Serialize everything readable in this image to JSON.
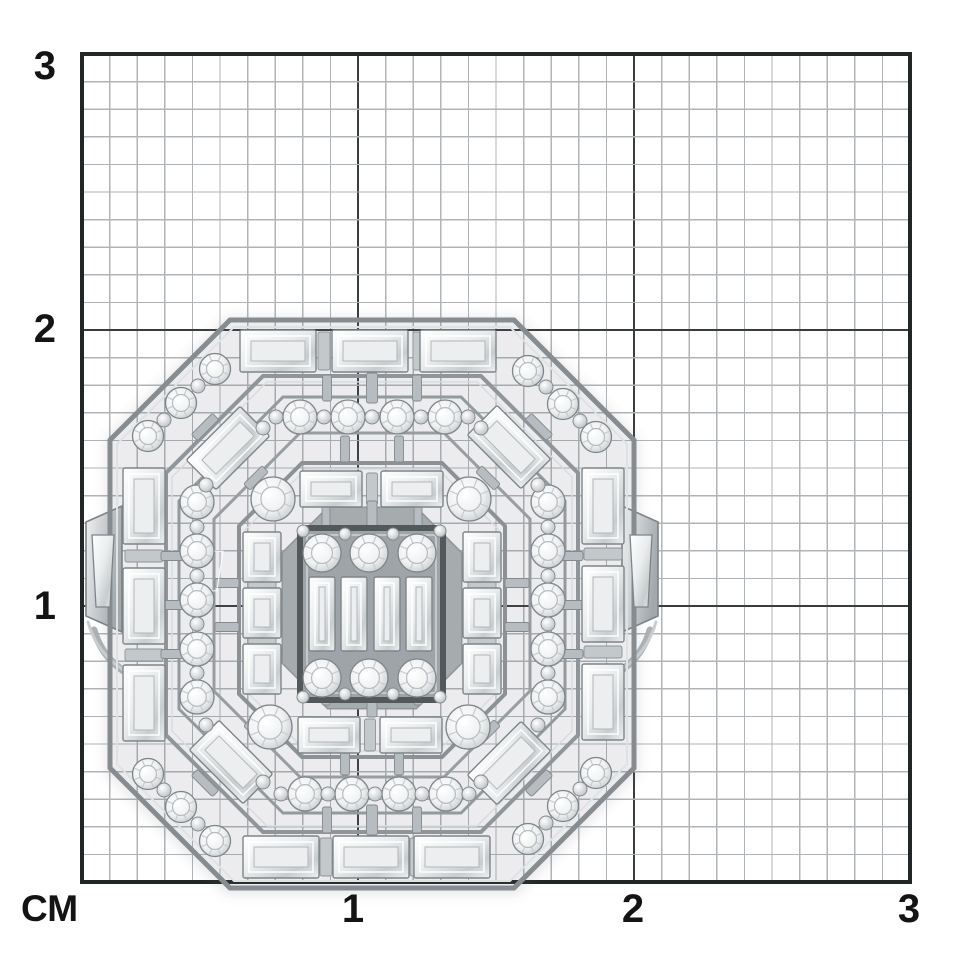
{
  "meta": {
    "description": "White-gold openwork cocktail ring with baguette and round diamonds photographed face-up on a centimeter measurement grid"
  },
  "grid": {
    "x0": 82,
    "y0": 54,
    "x1": 910,
    "y1": 882,
    "cm_px": 276,
    "minor_per_cm": 10,
    "minor_color": "#b0b4b6",
    "major_color": "#3a3d3e",
    "border_color": "#232626",
    "left_labels": [
      {
        "text": "3"
      },
      {
        "text": "2"
      },
      {
        "text": "1"
      }
    ],
    "bottom_labels": [
      {
        "text": "1"
      },
      {
        "text": "2"
      },
      {
        "text": "3"
      }
    ],
    "unit": {
      "text": "СМ"
    }
  },
  "ring": {
    "palette": {
      "rail_dark": "#868c90",
      "rail_mid": "#9aa1a5",
      "rail_light": "#dfe2e3",
      "strut_fill": "#b6bcbf",
      "strut_edge": "#83898d",
      "bar_fill": "#c3c8cb",
      "bar_edge": "#8d9397",
      "plate_edge": "#7c8286",
      "inner_fill": "#a6abae",
      "cluster_fill": "#9ea4a7",
      "cluster_frame": "#53585b",
      "cluster_hi": "#d0d4d6",
      "stone_edge": "#7e8488",
      "stone_mid_line": "#ffffff",
      "stone_core": "#eceeef",
      "stone_core_edge": "#b2b7ba",
      "round_inner": "#b6bbbe",
      "round_spoke": "#c6cbce",
      "bead_edge": "#858b8f",
      "shadow": "rgba(95,101,105,0.12)"
    },
    "shadow_oct": [
      372,
      606,
      268,
      290,
      122
    ],
    "rails": [
      [
        372,
        604,
        262,
        284,
        120,
        5,
        "#868c90"
      ],
      [
        372,
        604,
        255,
        277,
        117,
        2,
        "#dfe2e3"
      ],
      [
        372,
        604,
        206,
        228,
        97,
        4,
        "#8f9599"
      ],
      [
        372,
        604,
        200,
        222,
        95,
        1.5,
        "#d8dbdd"
      ],
      [
        372,
        605,
        193,
        208,
        104,
        3,
        "#939a9d"
      ],
      [
        372,
        605,
        158,
        172,
        86,
        3,
        "#979da0"
      ],
      [
        372,
        610,
        133,
        147,
        63,
        4,
        "#8b9195"
      ],
      [
        372,
        610,
        127,
        141,
        61,
        1.5,
        "#d8dbdd"
      ],
      [
        372,
        608,
        89,
        100,
        45,
        3,
        "#8f9599"
      ]
    ],
    "inner_fill_oct": [
      372,
      608,
      89,
      100,
      45
    ],
    "shank": {
      "plates": [
        [
          [
            86,
            522
          ],
          [
            122,
            506
          ],
          [
            122,
            632
          ],
          [
            86,
            616
          ]
        ],
        [
          [
            622,
            506
          ],
          [
            658,
            522
          ],
          [
            658,
            616
          ],
          [
            622,
            632
          ]
        ]
      ],
      "arcs": [
        {
          "d": "M 94 630 C 102 658 122 674 150 684",
          "w": 7,
          "c": "#aab0b3"
        },
        {
          "d": "M 88 622 C 96 650 114 668 140 678",
          "w": 3,
          "c": "#c9cdcf"
        },
        {
          "d": "M 650 630 C 642 658 622 674 594 684",
          "w": 7,
          "c": "#aab0b3"
        },
        {
          "d": "M 656 622 C 648 650 630 668 604 678",
          "w": 3,
          "c": "#c9cdcf"
        }
      ],
      "taper_stones": [
        [
          [
            92,
            535
          ],
          [
            114,
            535
          ],
          [
            110,
            607
          ],
          [
            96,
            607
          ]
        ],
        [
          [
            630,
            535
          ],
          [
            652,
            535
          ],
          [
            648,
            607
          ],
          [
            634,
            607
          ]
        ]
      ]
    },
    "channel_bars": [
      [
        324,
        351,
        38,
        90,
        12
      ],
      [
        419,
        351,
        38,
        90,
        12
      ],
      [
        326,
        857,
        38,
        90,
        12
      ],
      [
        416,
        857,
        38,
        90,
        12
      ],
      [
        144,
        556,
        38,
        0,
        12
      ],
      [
        144,
        655,
        38,
        0,
        12
      ],
      [
        603,
        554,
        38,
        0,
        12
      ],
      [
        603,
        652,
        38,
        0,
        12
      ],
      [
        372,
        489,
        32,
        90,
        11
      ],
      [
        370,
        735,
        32,
        90,
        11
      ],
      [
        262,
        585,
        28,
        0,
        10
      ],
      [
        262,
        641,
        28,
        0,
        10
      ],
      [
        482,
        585,
        28,
        0,
        10
      ],
      [
        482,
        641,
        28,
        0,
        10
      ]
    ],
    "struts": [
      [
        327,
        388,
        26,
        90,
        9
      ],
      [
        372,
        388,
        30,
        90,
        11
      ],
      [
        417,
        388,
        26,
        90,
        9
      ],
      [
        327,
        820,
        26,
        90,
        9
      ],
      [
        372,
        820,
        30,
        90,
        11
      ],
      [
        417,
        820,
        26,
        90,
        9
      ],
      [
        172,
        556,
        22,
        0,
        9
      ],
      [
        172,
        605,
        22,
        0,
        9
      ],
      [
        172,
        654,
        22,
        0,
        9
      ],
      [
        572,
        556,
        22,
        0,
        9
      ],
      [
        572,
        605,
        22,
        0,
        9
      ],
      [
        572,
        654,
        22,
        0,
        9
      ],
      [
        345,
        449,
        26,
        90,
        9
      ],
      [
        399,
        449,
        26,
        90,
        9
      ],
      [
        345,
        762,
        26,
        90,
        9
      ],
      [
        399,
        762,
        26,
        90,
        9
      ],
      [
        227,
        583,
        24,
        0,
        9
      ],
      [
        227,
        627,
        24,
        0,
        9
      ],
      [
        517,
        583,
        24,
        0,
        9
      ],
      [
        517,
        627,
        24,
        0,
        9
      ],
      [
        372,
        514,
        26,
        90,
        10
      ],
      [
        326,
        516,
        22,
        90,
        8
      ],
      [
        418,
        516,
        22,
        90,
        8
      ],
      [
        372,
        704,
        26,
        90,
        10
      ],
      [
        326,
        694,
        22,
        90,
        8
      ],
      [
        418,
        694,
        22,
        90,
        8
      ],
      [
        205,
        427,
        30,
        -45,
        9
      ],
      [
        256,
        478,
        26,
        -45,
        9
      ],
      [
        539,
        427,
        30,
        45,
        9
      ],
      [
        488,
        478,
        26,
        45,
        9
      ],
      [
        205,
        783,
        30,
        45,
        9
      ],
      [
        256,
        732,
        26,
        45,
        9
      ],
      [
        539,
        783,
        30,
        -45,
        9
      ],
      [
        488,
        732,
        26,
        -45,
        9
      ]
    ],
    "cluster_frame": {
      "x": 300,
      "y": 528,
      "w": 143,
      "h": 172
    },
    "baguettes": [
      [
        278,
        351,
        76,
        42,
        0
      ],
      [
        370,
        351,
        76,
        42,
        0
      ],
      [
        458,
        351,
        76,
        42,
        0
      ],
      [
        281,
        857,
        76,
        42,
        0
      ],
      [
        371,
        857,
        76,
        42,
        0
      ],
      [
        452,
        857,
        76,
        42,
        0
      ],
      [
        144,
        506,
        42,
        76,
        0
      ],
      [
        144,
        606,
        42,
        76,
        0
      ],
      [
        144,
        703,
        42,
        76,
        0
      ],
      [
        603,
        506,
        42,
        76,
        0
      ],
      [
        603,
        604,
        42,
        76,
        0
      ],
      [
        603,
        702,
        42,
        76,
        0
      ],
      [
        228,
        448,
        76,
        42,
        -45
      ],
      [
        509,
        447,
        76,
        42,
        45
      ],
      [
        231,
        762,
        76,
        42,
        45
      ],
      [
        509,
        763,
        76,
        42,
        -45
      ],
      [
        331,
        489,
        62,
        36,
        0
      ],
      [
        412,
        489,
        62,
        36,
        0
      ],
      [
        329,
        735,
        62,
        36,
        0
      ],
      [
        411,
        735,
        62,
        36,
        0
      ],
      [
        262,
        557,
        38,
        50,
        0
      ],
      [
        262,
        613,
        38,
        50,
        0
      ],
      [
        262,
        669,
        38,
        50,
        0
      ],
      [
        482,
        557,
        38,
        50,
        0
      ],
      [
        482,
        613,
        38,
        50,
        0
      ],
      [
        482,
        669,
        38,
        50,
        0
      ],
      [
        322,
        614,
        26,
        74,
        0
      ],
      [
        354,
        614,
        26,
        74,
        0
      ],
      [
        387,
        614,
        26,
        74,
        0
      ],
      [
        419,
        614,
        26,
        74,
        0
      ]
    ],
    "rounds": [
      [
        215,
        369,
        15.5
      ],
      [
        181,
        403,
        15.5
      ],
      [
        148,
        436,
        15.5
      ],
      [
        528,
        371,
        15.5
      ],
      [
        563,
        404,
        15.5
      ],
      [
        596,
        437,
        15.5
      ],
      [
        148,
        774,
        15.5
      ],
      [
        181,
        807,
        15.5
      ],
      [
        215,
        841,
        15.5
      ],
      [
        596,
        773,
        15.5
      ],
      [
        563,
        806,
        15.5
      ],
      [
        528,
        839,
        15.5
      ],
      [
        300,
        417,
        17
      ],
      [
        348,
        417,
        17
      ],
      [
        397,
        417,
        17
      ],
      [
        445,
        417,
        17
      ],
      [
        305,
        794,
        17
      ],
      [
        352,
        794,
        17
      ],
      [
        399,
        794,
        17
      ],
      [
        446,
        794,
        17
      ],
      [
        197,
        502,
        17
      ],
      [
        197,
        551,
        17
      ],
      [
        197,
        600,
        17
      ],
      [
        197,
        649,
        17
      ],
      [
        197,
        697,
        17
      ],
      [
        548,
        502,
        17
      ],
      [
        548,
        551,
        17
      ],
      [
        548,
        600,
        17
      ],
      [
        548,
        649,
        17
      ],
      [
        548,
        697,
        17
      ],
      [
        273,
        499,
        22
      ],
      [
        469,
        499,
        22
      ],
      [
        270,
        727,
        22
      ],
      [
        468,
        727,
        22
      ],
      [
        322,
        553,
        19
      ],
      [
        369,
        553,
        19
      ],
      [
        417,
        553,
        19
      ],
      [
        322,
        678,
        19
      ],
      [
        369,
        678,
        19
      ],
      [
        417,
        678,
        19
      ]
    ],
    "beads": [
      [
        198,
        386,
        7
      ],
      [
        164,
        420,
        7
      ],
      [
        546,
        387,
        7
      ],
      [
        580,
        421,
        7
      ],
      [
        164,
        790,
        7
      ],
      [
        198,
        824,
        7
      ],
      [
        580,
        789,
        7
      ],
      [
        546,
        823,
        7
      ],
      [
        276,
        417,
        7
      ],
      [
        324,
        417,
        7
      ],
      [
        372,
        417,
        7
      ],
      [
        421,
        417,
        7
      ],
      [
        468,
        417,
        7
      ],
      [
        281,
        794,
        7
      ],
      [
        328,
        794,
        7
      ],
      [
        375,
        794,
        7
      ],
      [
        422,
        794,
        7
      ],
      [
        469,
        794,
        7
      ],
      [
        197,
        527,
        7
      ],
      [
        197,
        576,
        7
      ],
      [
        197,
        624,
        7
      ],
      [
        197,
        673,
        7
      ],
      [
        548,
        527,
        7
      ],
      [
        548,
        576,
        7
      ],
      [
        548,
        624,
        7
      ],
      [
        548,
        673,
        7
      ],
      [
        263,
        428,
        7
      ],
      [
        481,
        428,
        7
      ],
      [
        206,
        485,
        7
      ],
      [
        538,
        485,
        7
      ],
      [
        263,
        782,
        7
      ],
      [
        481,
        782,
        7
      ],
      [
        206,
        725,
        7
      ],
      [
        538,
        725,
        7
      ],
      [
        303,
        531,
        6
      ],
      [
        440,
        531,
        6
      ],
      [
        303,
        697,
        6
      ],
      [
        440,
        697,
        6
      ],
      [
        345,
        534,
        6
      ],
      [
        393,
        534,
        6
      ],
      [
        345,
        694,
        6
      ],
      [
        393,
        694,
        6
      ]
    ]
  }
}
